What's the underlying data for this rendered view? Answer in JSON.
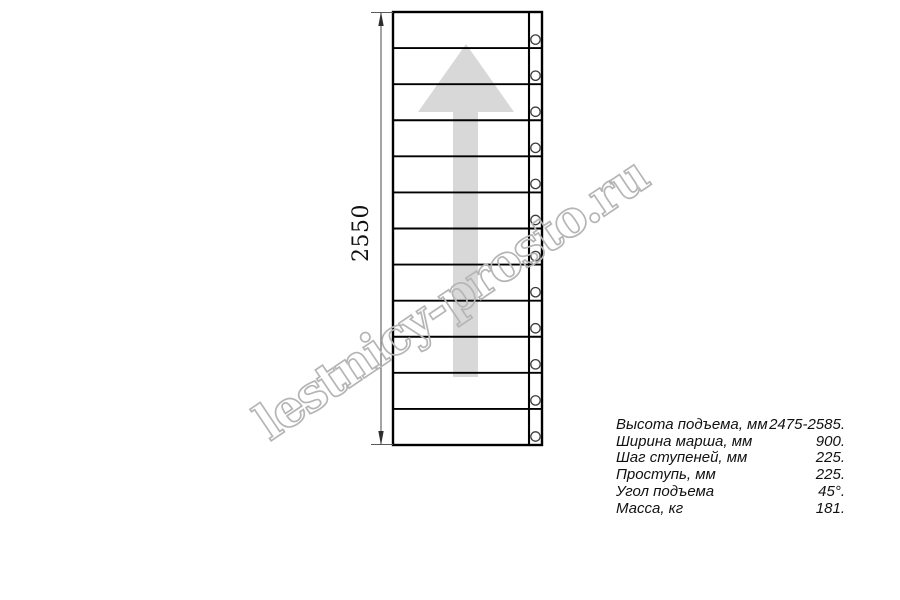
{
  "drawing": {
    "title_semantic": "straight-stair-flight-plan-view",
    "dimension_label": "2550",
    "step_rows": 12,
    "arrow_direction": "up",
    "line_color": "#000000",
    "arrow_color": "#d8d8d8",
    "dim_line_color": "#5a5a5a",
    "dim_arrow_color": "#2e2e2e",
    "baluster_stroke_color": "#3c3c3c"
  },
  "watermark": {
    "text": "lestnicy-prosto.ru",
    "color": "#b5b5b5"
  },
  "specs": {
    "rows": [
      {
        "label": "Высота подъема, мм",
        "value": "2475-2585."
      },
      {
        "label": "Ширина марша, мм",
        "value": "900."
      },
      {
        "label": "Шаг ступеней, мм",
        "value": "225."
      },
      {
        "label": "Проступь, мм",
        "value": "225."
      },
      {
        "label": "Угол подъема",
        "value": "45°."
      },
      {
        "label": "Масса, кг",
        "value": "181."
      }
    ]
  }
}
